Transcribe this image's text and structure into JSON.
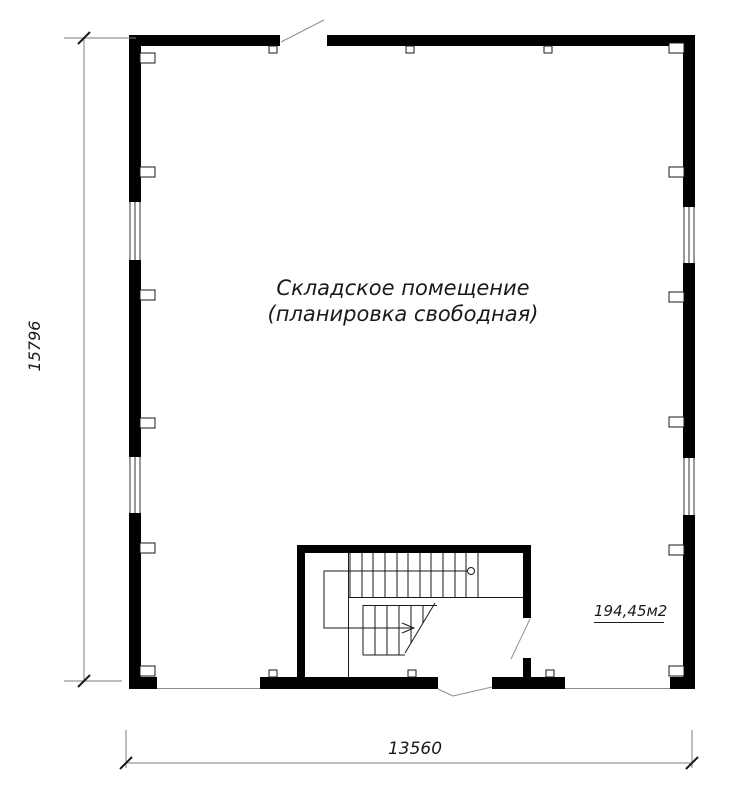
{
  "drawing": {
    "type": "architectural-floor-plan",
    "room": {
      "label_line1": "Складское помещение",
      "label_line2": "(планировка свободная)",
      "area_label": "194,45м2"
    },
    "dimensions": {
      "vertical": "15796",
      "horizontal": "13560"
    },
    "colors": {
      "wall": "#000000",
      "thin_line": "#1a1a1a",
      "dim_line": "#7d7d7d",
      "swing_line": "#8f8f8f",
      "background": "#ffffff"
    }
  }
}
